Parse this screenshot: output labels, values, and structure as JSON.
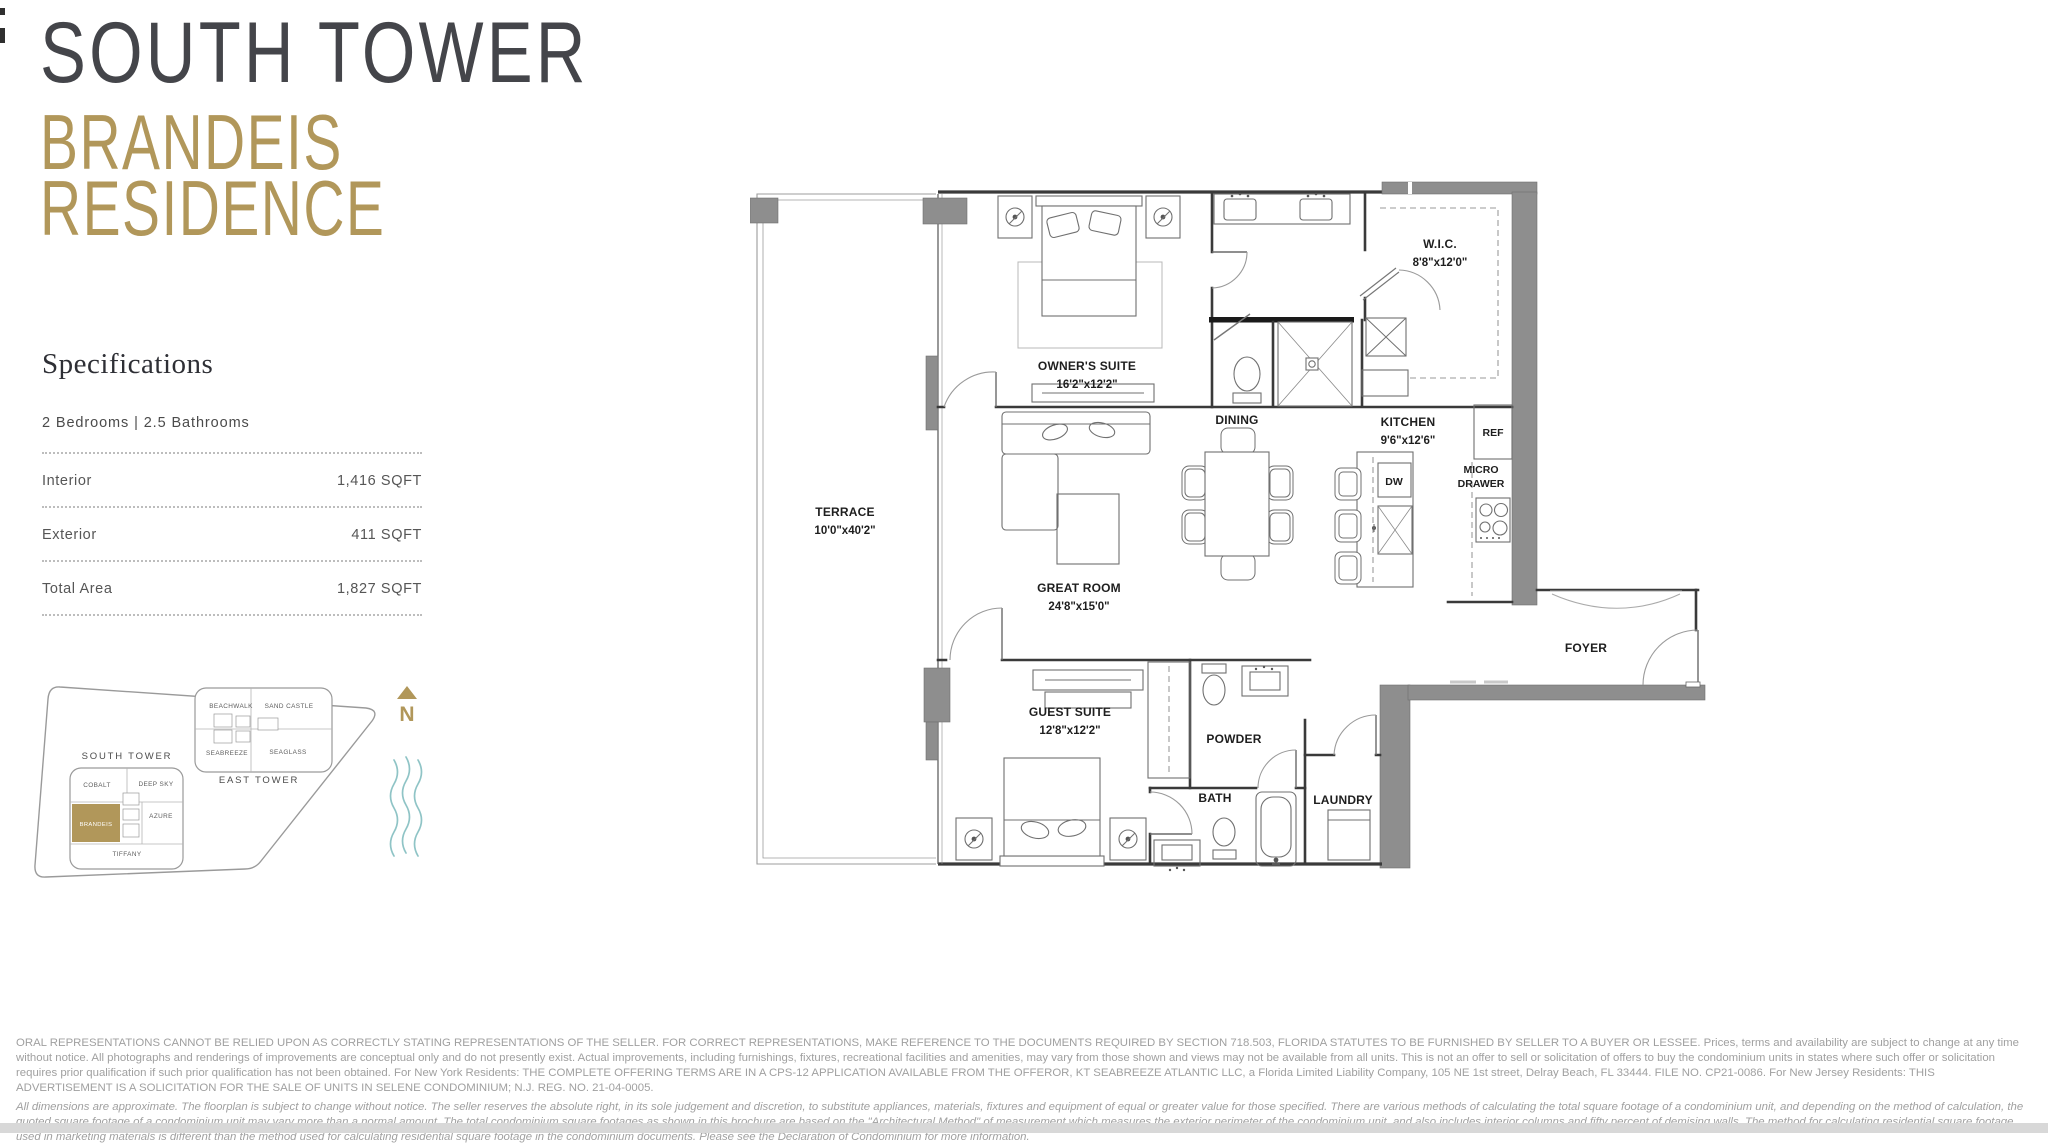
{
  "header": {
    "line1": "SOUTH TOWER",
    "line2": "BRANDEIS",
    "line3": "RESIDENCE"
  },
  "specifications": {
    "title": "Specifications",
    "summary": "2 Bedrooms  |  2.5 Bathrooms",
    "rows": [
      {
        "label": "Interior",
        "value": "1,416 SQFT"
      },
      {
        "label": "Exterior",
        "value": "411 SQFT"
      },
      {
        "label": "Total Area",
        "value": "1,827 SQFT"
      }
    ]
  },
  "site_map": {
    "north": "N",
    "south_tower": {
      "label": "SOUTH TOWER",
      "units": {
        "cobalt": "COBALT",
        "deep_sky": "DEEP SKY",
        "brandeis": "BRANDEIS",
        "azure": "AZURE",
        "tiffany": "TIFFANY"
      },
      "highlighted_unit": "BRANDEIS"
    },
    "east_tower": {
      "label": "EAST TOWER",
      "units": {
        "beachwalk": "BEACHWALK",
        "sand_castle": "SAND CASTLE",
        "seabreeze": "SEABREEZE",
        "seaglass": "SEAGLASS"
      }
    },
    "colors": {
      "highlight": "#b1975a",
      "water": "#8fc4c6"
    }
  },
  "floor_plan": {
    "terrace": {
      "name": "TERRACE",
      "dims": "10'0\"x40'2\""
    },
    "owner_suite": {
      "name": "OWNER'S SUITE",
      "dims": "16'2\"x12'2\""
    },
    "wic": {
      "name": "W.I.C.",
      "dims": "8'8\"x12'0\""
    },
    "dining": {
      "name": "DINING"
    },
    "kitchen": {
      "name": "KITCHEN",
      "dims": "9'6\"x12'6\""
    },
    "great_room": {
      "name": "GREAT ROOM",
      "dims": "24'8\"x15'0\""
    },
    "guest_suite": {
      "name": "GUEST SUITE",
      "dims": "12'8\"x12'2\""
    },
    "powder": {
      "name": "POWDER"
    },
    "bath": {
      "name": "BATH"
    },
    "laundry": {
      "name": "LAUNDRY"
    },
    "foyer": {
      "name": "FOYER"
    },
    "appliances": {
      "ref": "REF",
      "micro_line1": "MICRO",
      "micro_line2": "DRAWER",
      "dw": "DW"
    }
  },
  "legal": {
    "paragraph1": "ORAL REPRESENTATIONS CANNOT BE RELIED UPON AS CORRECTLY STATING REPRESENTATIONS OF THE SELLER. FOR CORRECT REPRESENTATIONS, MAKE REFERENCE TO THE DOCUMENTS REQUIRED BY SECTION 718.503, FLORIDA STATUTES TO BE FURNISHED BY SELLER TO A BUYER OR LESSEE. Prices, terms and availability are subject to change at any time without notice. All photographs and renderings of improvements are conceptual only and do not presently exist. Actual improvements, including furnishings, fixtures, recreational facilities and amenities, may vary from those shown and views may not be available from all units. This is not an offer to sell or solicitation of offers to buy the condominium units in states where such offer or solicitation requires prior qualification if such prior qualification has not been obtained. For New York Residents: THE COMPLETE OFFERING TERMS ARE IN A CPS-12 APPLICATION AVAILABLE FROM THE OFFEROR, KT SEABREEZE ATLANTIC LLC, a Florida Limited Liability Company, 105 NE 1st street, Delray Beach, FL 33444. FILE NO. CP21-0086. For New Jersey Residents: THIS ADVERTISEMENT IS A SOLICITATION FOR THE SALE OF UNITS IN SELENE CONDOMINIUM; N.J. REG. NO. 21-04-0005.",
    "paragraph2": "All dimensions are approximate. The floorplan is subject to change without notice. The seller reserves the absolute right, in its sole judgement and discretion, to substitute appliances, materials, fixtures and equipment of equal or greater value for those specified. There are various methods of calculating the total square footage of a condominium unit, and depending on the method of calculation, the quoted square footage of a condominium unit may vary more than a normal amount. The total condominium square footages as shown in this brochure are based on the \"Architectural Method\" of measurement which measures the exterior perimeter of the condominium unit, and also includes interior columns and fifty percent of demising walls. The method for calculating residential square footage used in marketing materials is different than the method used for calculating residential square footage in the condominium documents. Please see the Declaration of Condominium for more information."
  }
}
